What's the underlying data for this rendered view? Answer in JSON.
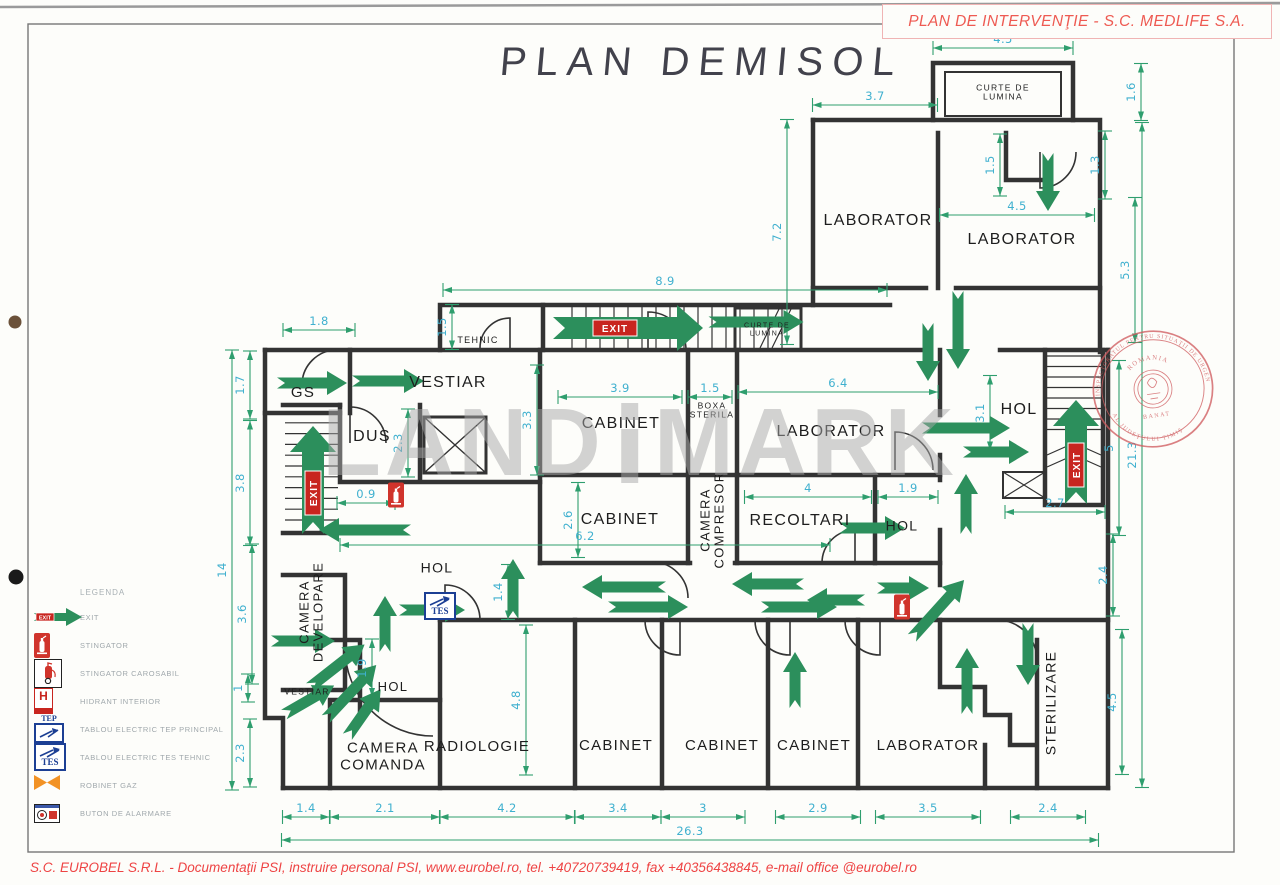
{
  "title": "PLAN DEMISOL",
  "header": {
    "label": "PLAN DE INTERVENŢIE - S.C. MEDLIFE S.A."
  },
  "footer": {
    "label": "S.C. EUROBEL S.R.L. - Documentaţii PSI, instruire personal PSI, www.eurobel.ro, tel. +40720739419, fax +40356438845, e-mail office @eurobel.ro"
  },
  "watermark": {
    "left": "LAND",
    "right": "MARK"
  },
  "stamp": {
    "arc_top": "INSPECTORATUL PENTRU SITUAŢII DE URGENŢĂ",
    "arc_bottom": "AL JUDEŢULUI TIMIŞ",
    "center_top": "ROMANIA",
    "center_bottom": "BANAT"
  },
  "exit_label": "EXIT",
  "tep_label": "TEP",
  "tes_label": "TES",
  "hydrant_label": "H",
  "colors": {
    "dim_line": "#2f9e6e",
    "dim_text": "#3fb0cf",
    "arrow": "#2c8f5c",
    "wall": "#333333",
    "red": "#c8251f",
    "accent_red": "#ee5a52",
    "stamp": "#cf5b5e",
    "watermark": "#a9a9a9",
    "panel_blue": "#1c3f94",
    "gas_orange": "#f29224"
  },
  "legend": {
    "heading": "LEGENDA",
    "items": [
      {
        "icon": "exit-arrow",
        "label": "EXIT"
      },
      {
        "icon": "extinguisher",
        "label": "STINGATOR"
      },
      {
        "icon": "extinguisher-cart",
        "label": "STINGATOR CAROSABIL"
      },
      {
        "icon": "hydrant",
        "label": "HIDRANT INTERIOR"
      },
      {
        "icon": "tep-panel",
        "label": "TABLOU ELECTRIC TEP PRINCIPAL"
      },
      {
        "icon": "tes-panel",
        "label": "TABLOU ELECTRIC TES TEHNIC"
      },
      {
        "icon": "gas-valve",
        "label": "ROBINET GAZ"
      },
      {
        "icon": "alarm-button",
        "label": "BUTON DE ALARMARE"
      }
    ]
  },
  "rooms": [
    {
      "label": "GS",
      "x": 303,
      "y": 393,
      "fs": 15,
      "rot": 0
    },
    {
      "label": "VESTIAR",
      "x": 448,
      "y": 383,
      "fs": 16,
      "rot": 0
    },
    {
      "label": "DUS",
      "x": 372,
      "y": 437,
      "fs": 16,
      "rot": 0
    },
    {
      "label": "TEHNIC",
      "x": 478,
      "y": 341,
      "fs": 9,
      "rot": 0
    },
    {
      "label": "CURTE DE\nLUMINA",
      "x": 767,
      "y": 330,
      "fs": 7,
      "rot": 0
    },
    {
      "label": "CURTE DE\nLUMINA",
      "x": 1003,
      "y": 93,
      "fs": 8.5,
      "rot": 0
    },
    {
      "label": "LABORATOR",
      "x": 878,
      "y": 221,
      "fs": 16,
      "rot": 0
    },
    {
      "label": "LABORATOR",
      "x": 1022,
      "y": 240,
      "fs": 16,
      "rot": 0
    },
    {
      "label": "CABINET",
      "x": 621,
      "y": 424,
      "fs": 16,
      "rot": 0
    },
    {
      "label": "BOXA\nSTERILA",
      "x": 712,
      "y": 411,
      "fs": 8.5,
      "rot": 0
    },
    {
      "label": "LABORATOR",
      "x": 831,
      "y": 432,
      "fs": 16,
      "rot": 0
    },
    {
      "label": "HOL",
      "x": 1019,
      "y": 410,
      "fs": 16,
      "rot": 0
    },
    {
      "label": "CABINET",
      "x": 620,
      "y": 520,
      "fs": 16,
      "rot": 0
    },
    {
      "label": "CAMERA\nCOMPRESOR",
      "x": 713,
      "y": 520,
      "fs": 13,
      "rot": -90
    },
    {
      "label": "RECOLTARI",
      "x": 800,
      "y": 521,
      "fs": 16,
      "rot": 0
    },
    {
      "label": "HOL",
      "x": 902,
      "y": 526,
      "fs": 14,
      "rot": 0
    },
    {
      "label": "HOL",
      "x": 437,
      "y": 568,
      "fs": 14,
      "rot": 0
    },
    {
      "label": "CAMERA\nDEVELOPARE",
      "x": 312,
      "y": 612,
      "fs": 13,
      "rot": -90
    },
    {
      "label": "HOL",
      "x": 393,
      "y": 687,
      "fs": 13,
      "rot": 0
    },
    {
      "label": "VESTIAR",
      "x": 307,
      "y": 692,
      "fs": 8.5,
      "rot": 0
    },
    {
      "label": "CAMERA\nCOMANDA",
      "x": 383,
      "y": 757,
      "fs": 15,
      "rot": 0
    },
    {
      "label": "RADIOLOGIE",
      "x": 477,
      "y": 747,
      "fs": 15,
      "rot": 0
    },
    {
      "label": "CABINET",
      "x": 616,
      "y": 746,
      "fs": 15,
      "rot": 0
    },
    {
      "label": "CABINET",
      "x": 722,
      "y": 746,
      "fs": 15,
      "rot": 0
    },
    {
      "label": "CABINET",
      "x": 814,
      "y": 746,
      "fs": 15,
      "rot": 0
    },
    {
      "label": "LABORATOR",
      "x": 928,
      "y": 746,
      "fs": 15,
      "rot": 0
    },
    {
      "label": "STERILIZARE",
      "x": 1051,
      "y": 703,
      "fs": 14,
      "rot": -90
    }
  ],
  "dims": [
    {
      "v": "8.9",
      "x": 665,
      "y": 290,
      "l": 444,
      "o": "h"
    },
    {
      "v": "3.7",
      "x": 875,
      "y": 105,
      "l": 125,
      "o": "h"
    },
    {
      "v": "4.5",
      "x": 1003,
      "y": 48,
      "l": 140,
      "o": "h"
    },
    {
      "v": "4.5",
      "x": 1017,
      "y": 215,
      "l": 155,
      "o": "h"
    },
    {
      "v": "1.8",
      "x": 319,
      "y": 330,
      "l": 72,
      "o": "h"
    },
    {
      "v": "0.9",
      "x": 366,
      "y": 503,
      "l": 58,
      "o": "h"
    },
    {
      "v": "6.2",
      "x": 585,
      "y": 545,
      "l": 490,
      "o": "h"
    },
    {
      "v": "3.9",
      "x": 620,
      "y": 397,
      "l": 124,
      "o": "h"
    },
    {
      "v": "1.5",
      "x": 710,
      "y": 397,
      "l": 44,
      "o": "h"
    },
    {
      "v": "6.4",
      "x": 838,
      "y": 392,
      "l": 200,
      "o": "h"
    },
    {
      "v": "4",
      "x": 808,
      "y": 497,
      "l": 127,
      "o": "h"
    },
    {
      "v": "1.9",
      "x": 908,
      "y": 497,
      "l": 60,
      "o": "h"
    },
    {
      "v": "2.7",
      "x": 1055,
      "y": 512,
      "l": 100,
      "o": "h"
    },
    {
      "v": "1.4",
      "x": 306,
      "y": 817,
      "l": 47,
      "o": "h"
    },
    {
      "v": "2.1",
      "x": 385,
      "y": 817,
      "l": 110,
      "o": "h"
    },
    {
      "v": "4.2",
      "x": 507,
      "y": 817,
      "l": 135,
      "o": "h"
    },
    {
      "v": "3.4",
      "x": 618,
      "y": 817,
      "l": 86,
      "o": "h"
    },
    {
      "v": "3",
      "x": 703,
      "y": 817,
      "l": 84,
      "o": "h"
    },
    {
      "v": "2.9",
      "x": 818,
      "y": 817,
      "l": 85,
      "o": "h"
    },
    {
      "v": "3.5",
      "x": 928,
      "y": 817,
      "l": 105,
      "o": "h"
    },
    {
      "v": "2.4",
      "x": 1048,
      "y": 817,
      "l": 75,
      "o": "h"
    },
    {
      "v": "26.3",
      "x": 690,
      "y": 840,
      "l": 817,
      "o": "h"
    },
    {
      "v": "7.2",
      "x": 787,
      "y": 232,
      "l": 225,
      "o": "v"
    },
    {
      "v": "1.6",
      "x": 1141,
      "y": 92,
      "l": 57,
      "o": "v"
    },
    {
      "v": "5.3",
      "x": 1135,
      "y": 270,
      "l": 145,
      "o": "v"
    },
    {
      "v": "1.5",
      "x": 1000,
      "y": 165,
      "l": 62,
      "o": "v"
    },
    {
      "v": "1.3",
      "x": 1105,
      "y": 165,
      "l": 68,
      "o": "v"
    },
    {
      "v": "1.5",
      "x": 452,
      "y": 327,
      "l": 45,
      "o": "v"
    },
    {
      "v": "1.7",
      "x": 250,
      "y": 385,
      "l": 68,
      "o": "v"
    },
    {
      "v": "3.8",
      "x": 250,
      "y": 483,
      "l": 125,
      "o": "v"
    },
    {
      "v": "2.3",
      "x": 408,
      "y": 443,
      "l": 68,
      "o": "v"
    },
    {
      "v": "3.3",
      "x": 537,
      "y": 420,
      "l": 110,
      "o": "v"
    },
    {
      "v": "2.6",
      "x": 578,
      "y": 520,
      "l": 75,
      "o": "v"
    },
    {
      "v": "3.1",
      "x": 990,
      "y": 413,
      "l": 75,
      "o": "v"
    },
    {
      "v": "1.4",
      "x": 508,
      "y": 592,
      "l": 55,
      "o": "v"
    },
    {
      "v": "1.9",
      "x": 372,
      "y": 668,
      "l": 58,
      "o": "v"
    },
    {
      "v": "4.8",
      "x": 526,
      "y": 700,
      "l": 150,
      "o": "v"
    },
    {
      "v": "5",
      "x": 1119,
      "y": 448,
      "l": 175,
      "o": "v"
    },
    {
      "v": "21.3",
      "x": 1142,
      "y": 455,
      "l": 665,
      "o": "v"
    },
    {
      "v": "2.4",
      "x": 1113,
      "y": 575,
      "l": 82,
      "o": "v"
    },
    {
      "v": "4.5",
      "x": 1122,
      "y": 702,
      "l": 145,
      "o": "v"
    },
    {
      "v": "3.6",
      "x": 252,
      "y": 614,
      "l": 140,
      "o": "v"
    },
    {
      "v": "1",
      "x": 248,
      "y": 688,
      "l": 28,
      "o": "v"
    },
    {
      "v": "2.3",
      "x": 250,
      "y": 753,
      "l": 68,
      "o": "v"
    },
    {
      "v": "14",
      "x": 232,
      "y": 570,
      "l": 440,
      "o": "v"
    }
  ],
  "arrows": [
    {
      "x": 312,
      "y": 383,
      "a": 0,
      "l": 70
    },
    {
      "x": 388,
      "y": 381,
      "a": 0,
      "l": 72
    },
    {
      "x": 365,
      "y": 530,
      "a": 180,
      "l": 92
    },
    {
      "x": 756,
      "y": 322,
      "a": 0,
      "l": 95
    },
    {
      "x": 1048,
      "y": 182,
      "a": 90,
      "l": 58
    },
    {
      "x": 958,
      "y": 330,
      "a": 90,
      "l": 78
    },
    {
      "x": 928,
      "y": 352,
      "a": 90,
      "l": 58
    },
    {
      "x": 966,
      "y": 428,
      "a": 0,
      "l": 88
    },
    {
      "x": 996,
      "y": 452,
      "a": 0,
      "l": 66
    },
    {
      "x": 966,
      "y": 504,
      "a": -90,
      "l": 60
    },
    {
      "x": 872,
      "y": 528,
      "a": 0,
      "l": 66
    },
    {
      "x": 513,
      "y": 589,
      "a": -90,
      "l": 60
    },
    {
      "x": 624,
      "y": 587,
      "a": 180,
      "l": 84
    },
    {
      "x": 648,
      "y": 607,
      "a": 0,
      "l": 80
    },
    {
      "x": 768,
      "y": 584,
      "a": 180,
      "l": 72
    },
    {
      "x": 799,
      "y": 607,
      "a": 0,
      "l": 76
    },
    {
      "x": 836,
      "y": 600,
      "a": 180,
      "l": 58
    },
    {
      "x": 385,
      "y": 624,
      "a": -90,
      "l": 56
    },
    {
      "x": 432,
      "y": 610,
      "a": 0,
      "l": 66
    },
    {
      "x": 303,
      "y": 641,
      "a": 0,
      "l": 64
    },
    {
      "x": 337,
      "y": 666,
      "a": -38,
      "l": 70
    },
    {
      "x": 351,
      "y": 692,
      "a": -47,
      "l": 74
    },
    {
      "x": 309,
      "y": 700,
      "a": -30,
      "l": 58
    },
    {
      "x": 364,
      "y": 713,
      "a": -55,
      "l": 58
    },
    {
      "x": 938,
      "y": 609,
      "a": -48,
      "l": 78
    },
    {
      "x": 967,
      "y": 681,
      "a": -90,
      "l": 66
    },
    {
      "x": 1028,
      "y": 654,
      "a": 90,
      "l": 62
    },
    {
      "x": 795,
      "y": 680,
      "a": -90,
      "l": 56
    },
    {
      "x": 903,
      "y": 588,
      "a": 0,
      "l": 52
    }
  ],
  "exits": [
    {
      "x": 628,
      "y": 328,
      "a": 0,
      "l": 150
    },
    {
      "x": 313,
      "y": 480,
      "a": -90,
      "l": 108
    },
    {
      "x": 1076,
      "y": 452,
      "a": -90,
      "l": 104
    }
  ],
  "icons": [
    {
      "kind": "extinguisher",
      "x": 396,
      "y": 495
    },
    {
      "kind": "extinguisher",
      "x": 902,
      "y": 607
    },
    {
      "kind": "tes-panel",
      "x": 440,
      "y": 606
    }
  ]
}
